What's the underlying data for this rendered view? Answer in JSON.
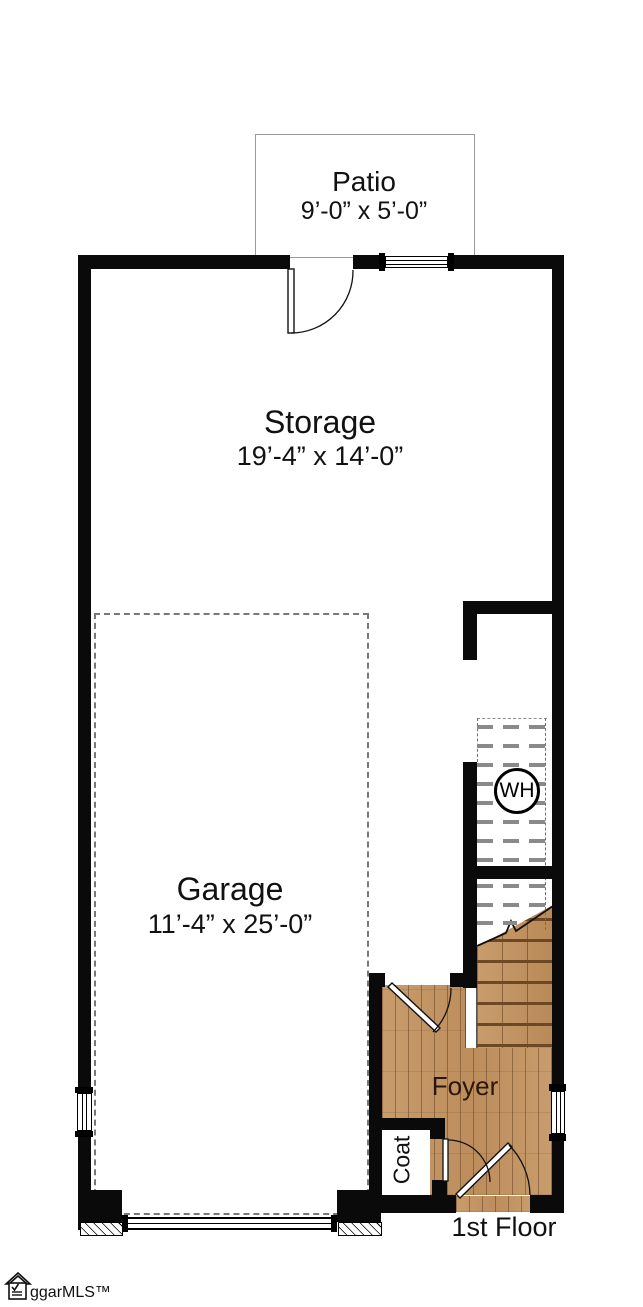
{
  "plan": {
    "floor_label": "1st Floor",
    "rooms": {
      "patio": {
        "name": "Patio",
        "dimensions": "9’-0” x 5’-0”"
      },
      "storage": {
        "name": "Storage",
        "dimensions": "19’-4” x 14’-0”"
      },
      "garage": {
        "name": "Garage",
        "dimensions": "11’-4” x 25’-0”"
      },
      "foyer": {
        "name": "Foyer"
      },
      "coat": {
        "name": "Coat"
      },
      "water_heater": {
        "label": "WH"
      }
    },
    "features": [
      "stairs",
      "entry-door",
      "patio-door",
      "garage-door",
      "windows"
    ],
    "colors": {
      "wall": "#0a0a0a",
      "wood_floor": "#c49464",
      "stair_dash_gray": "#8a8a8a",
      "garage_dashed_outline": "#787878",
      "foyer_text": "#2a160a"
    }
  },
  "footer": {
    "logo_text": "ggarMLS™"
  }
}
